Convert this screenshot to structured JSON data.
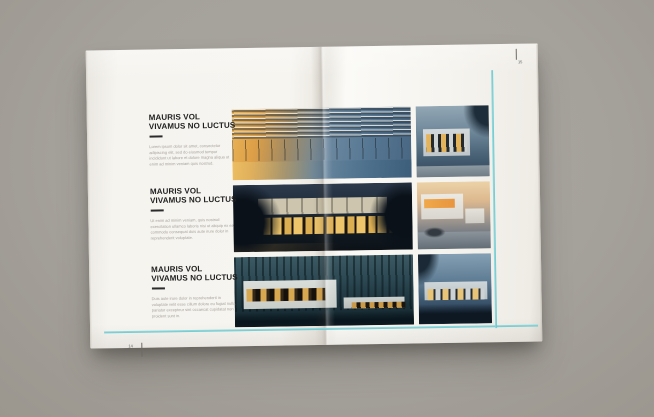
{
  "document": {
    "kind_label": "architecture-brochure-spread"
  },
  "left_page": {
    "page_number": "14",
    "sections": [
      {
        "heading_line1": "MAURIS VOL",
        "heading_line2": "VIVAMUS NO LUCTUS",
        "body": "Lorem ipsum dolor sit amet, consectetur adipiscing elit, sed do eiusmod tempor incididunt ut labore et dolore magna aliqua ut enim ad minim veniam quis nostrud."
      },
      {
        "heading_line1": "MAURIS VOL",
        "heading_line2": "VIVAMUS NO LUCTUS",
        "body": "Ut enim ad minim veniam, quis nostrud exercitation ullamco laboris nisi ut aliquip ex ea commodo consequat duis aute irure dolor in reprehenderit voluptate."
      },
      {
        "heading_line1": "MAURIS VOL",
        "heading_line2": "VIVAMUS NO LUCTUS",
        "body": "Duis aute irure dolor in reprehenderit in voluptate velit esse cillum dolore eu fugiat nulla pariatur excepteur sint occaecat cupidatat non proident sunt in."
      }
    ]
  },
  "right_page": {
    "page_number": "15"
  },
  "photos": [
    {
      "name": "villa-terrace-dusk-photo"
    },
    {
      "name": "night-house-lit-windows-photo"
    },
    {
      "name": "forest-white-house-photo"
    },
    {
      "name": "cubic-house-dusk-photo"
    },
    {
      "name": "house-with-car-dusk-photo"
    },
    {
      "name": "single-story-house-dusk-photo"
    }
  ],
  "colors": {
    "background_gray": "#a5a19b",
    "page_white": "#f6f4ef",
    "heading_text": "#1f1f1f",
    "body_text": "#a6a29c",
    "guide_cyan": "#6fcdd4",
    "page_number_text": "#5e5e5e"
  }
}
